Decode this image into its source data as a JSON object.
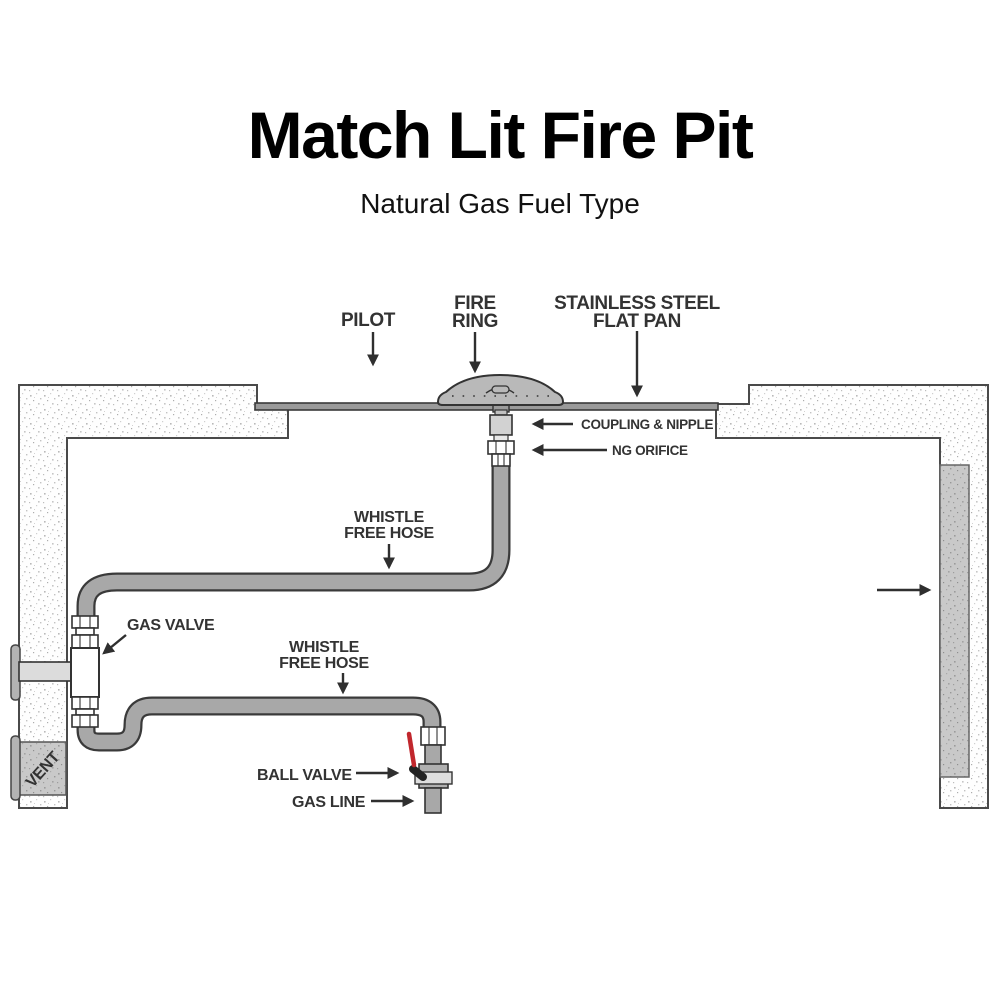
{
  "title": "Match Lit Fire Pit",
  "subtitle": "Natural Gas Fuel Type",
  "labels": {
    "pilot": "PILOT",
    "fire_ring": {
      "line1": "FIRE",
      "line2": "RING"
    },
    "flat_pan": {
      "line1": "STAINLESS STEEL",
      "line2": "FLAT PAN"
    },
    "coupling_nipple": "COUPLING & NIPPLE",
    "ng_orifice": "NG ORIFICE",
    "whistle_hose_upper": {
      "line1": "WHISTLE",
      "line2": "FREE HOSE"
    },
    "gas_valve": "GAS VALVE",
    "whistle_hose_lower": {
      "line1": "WHISTLE",
      "line2": "FREE HOSE"
    },
    "ball_valve": "BALL VALVE",
    "gas_line": "GAS LINE",
    "vent": "VENT"
  },
  "colors": {
    "label_text": "#333333",
    "title_text": "#000000",
    "hose_gray": "#a8a8a8",
    "pan_gray": "#9a9a9a",
    "fire_ring_gray": "#b9b9b9",
    "wall_outline": "#4a4a4a",
    "vent_gray": "#c9c9c9",
    "ball_valve_handle_red": "#c1272d"
  }
}
